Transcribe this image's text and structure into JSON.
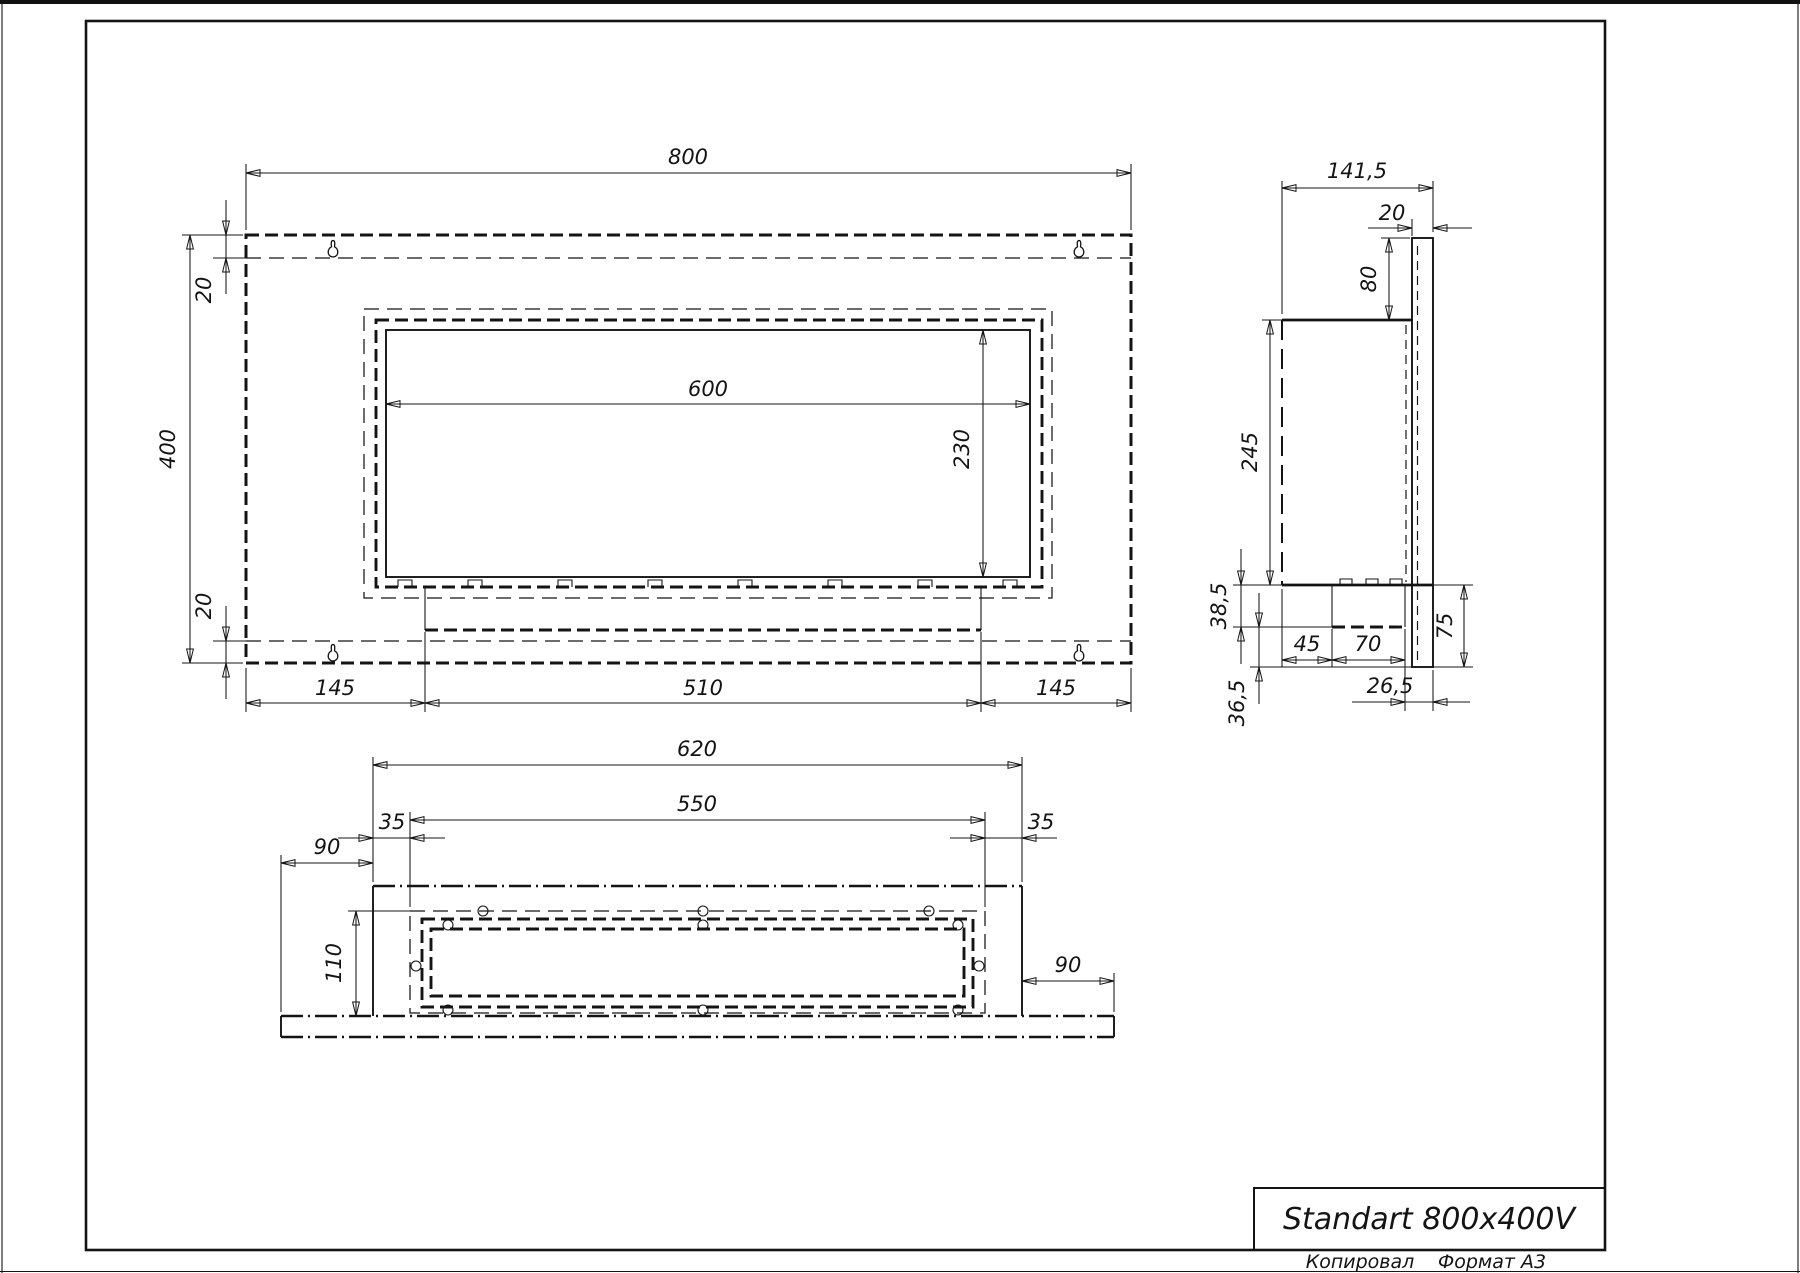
{
  "drawing": {
    "front_view": {
      "dims": {
        "overall_width": "800",
        "overall_height": "400",
        "top_inset": "20",
        "bottom_inset": "20",
        "window_width": "600",
        "window_height": "230",
        "left_margin": "145",
        "burner_width": "510",
        "right_margin": "145"
      }
    },
    "side_view": {
      "dims": {
        "overall_depth": "141,5",
        "panel_thickness": "20",
        "panel_top_extension": "80",
        "body_height": "245",
        "tray_height": "38,5",
        "tray_offset_front": "45",
        "tray_depth": "70",
        "panel_bottom_extension": "75",
        "bottom_clearance": "36,5",
        "rear_clearance": "26,5"
      }
    },
    "bottom_view": {
      "dims": {
        "body_width": "620",
        "flange_width": "550",
        "flange_margin_left": "35",
        "flange_margin_right": "35",
        "panel_overhang_left": "90",
        "panel_overhang_right": "90",
        "flange_depth": "110"
      }
    },
    "title_block": {
      "title": "Standart 800x400V",
      "copied_by_label": "Копировал",
      "format_label": "Формат А3"
    }
  }
}
